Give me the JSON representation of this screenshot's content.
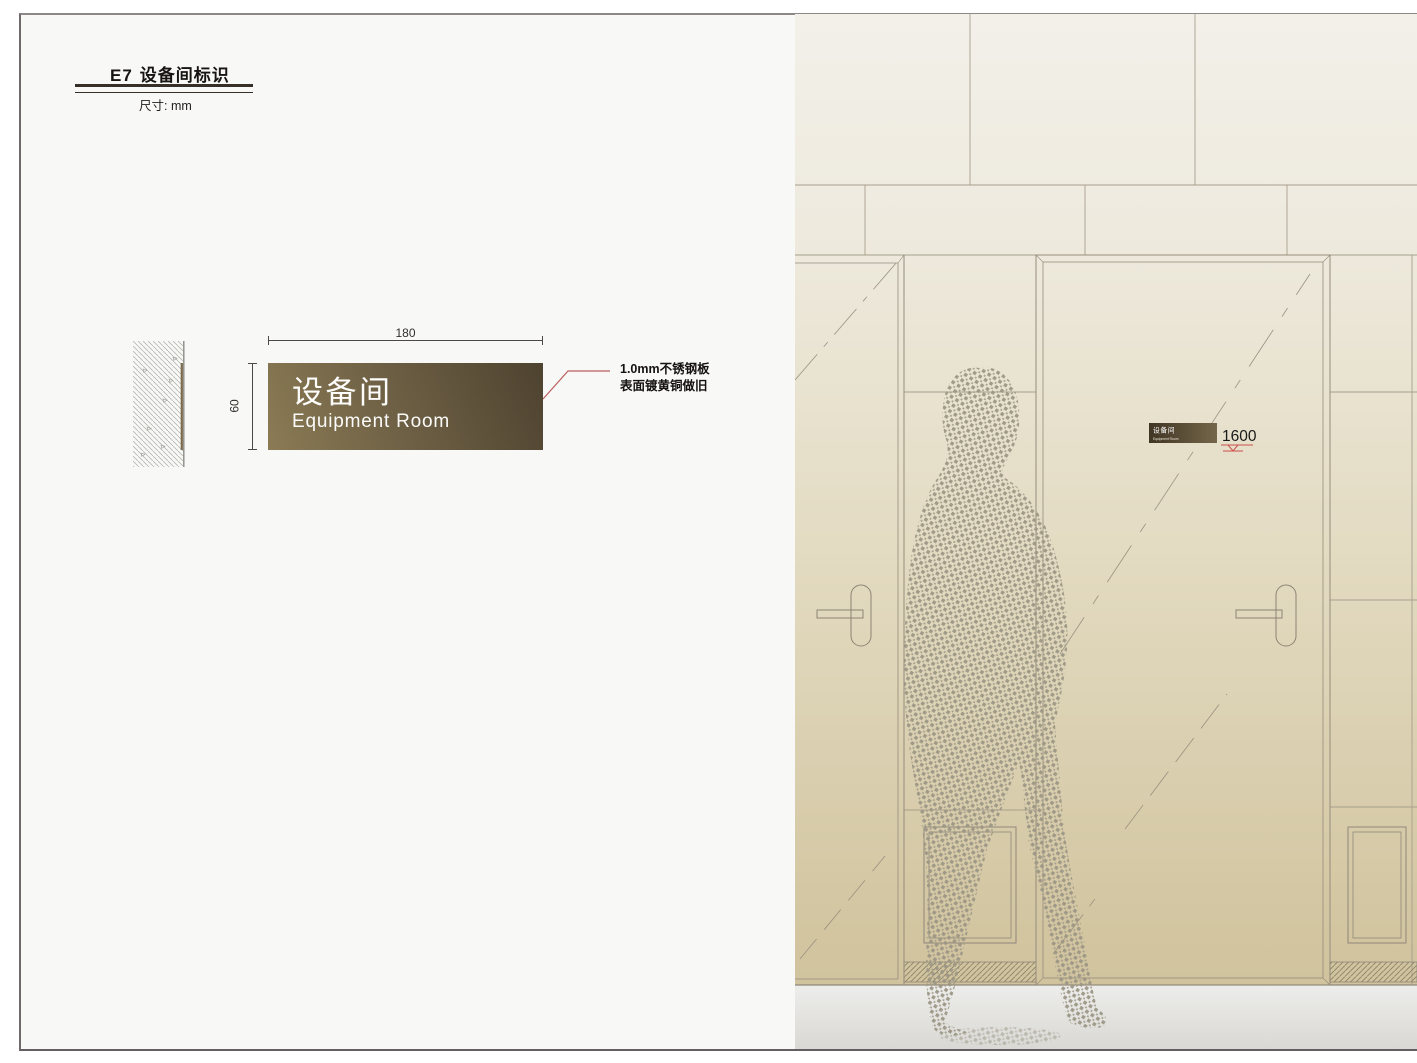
{
  "header": {
    "code": "E7",
    "title": "设备间标识",
    "units": "尺寸: mm"
  },
  "spec_view": {
    "width_dim": "180",
    "height_dim": "60",
    "sign": {
      "cn": "设备间",
      "en": "Equipment Room"
    },
    "material_note": {
      "line1": "1.0mm不锈钢板",
      "line2": "表面镀黄铜做旧"
    }
  },
  "elevation_view": {
    "door_sign": {
      "cn": "设备间",
      "en": "Equipment Room"
    },
    "mounting_height": "1600"
  },
  "colors": {
    "sign_gradient_light": "#8b7b55",
    "sign_gradient_dark": "#4e4330",
    "leader_red": "#bb5f5f",
    "level_marker_red": "#c94f4a",
    "wall_tan": "#d2c5a0"
  }
}
